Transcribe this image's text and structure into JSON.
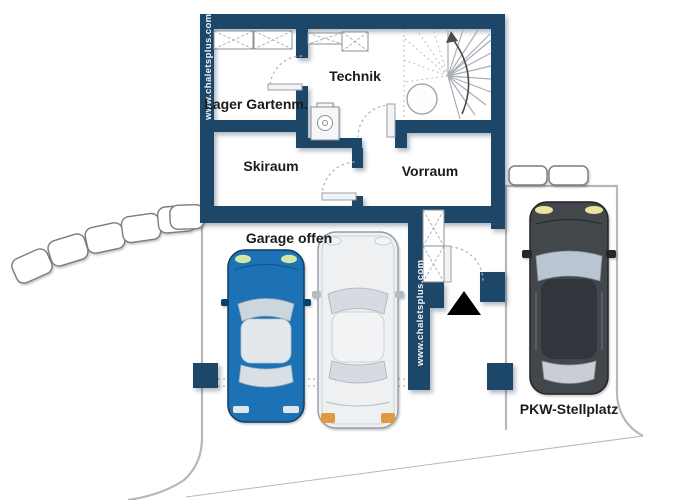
{
  "labels": {
    "technik": "Technik",
    "lager_gartenm": "Lager Gartenm.",
    "skiraum": "Skiraum",
    "vorraum": "Vorraum",
    "garage_offen": "Garage offen",
    "pkw_stellplatz": "PKW-Stellplatz"
  },
  "watermarks": {
    "left_wall": "www.chaletsplus.com",
    "garage_wall": "www.chaletsplus.com"
  },
  "colors": {
    "wall": "#1b4769",
    "label_text": "#1b1b1b",
    "watermark_text": "#ffffff",
    "car_blue": "#1e72b4",
    "car_silver": "#eef0f2",
    "car_dark": "#43464c",
    "taillight_orange": "#e09a40",
    "headlight_green": "#cfe8a8",
    "entrance_marker": "#000000"
  }
}
